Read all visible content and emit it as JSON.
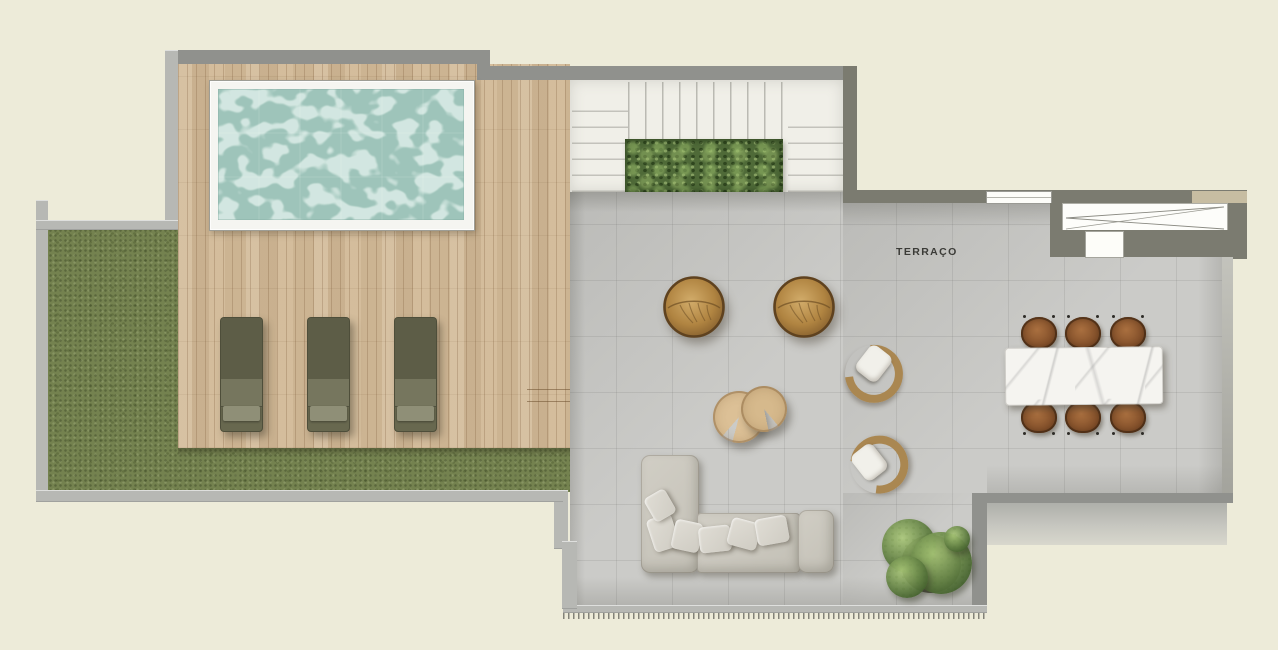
{
  "document_type": "roof terrace floor plan (top view render)",
  "labels": {
    "terrace": "TERRAÇO"
  },
  "colors": {
    "background": "#edebd9",
    "wall_dark": "#7b7b70",
    "wall_medium": "#90918d",
    "wall_light": "#b7b8b4",
    "wood_deck": "#d2ba98",
    "grass": "#74824f",
    "tile": "#cbcbc8",
    "stairs": "#f0efe8",
    "hedge": "#4f6a38",
    "pool_water": "#a5cbc1",
    "pool_frame": "#f5f5f1",
    "pouf": "#bb954f",
    "lounger": "#68684f",
    "side_table": "#dcc096",
    "armchair_frame": "#aa8751",
    "cushion": "#f1f0ea",
    "sofa": "#c9c6bc",
    "marble": "#f5f4f0",
    "dining_chair": "#8d5834",
    "plant_green": "#5f7d41",
    "label_color": "#3b3b37"
  },
  "areas": [
    "lawn",
    "wood deck",
    "swimming pool",
    "staircase with hedge planter",
    "terrace (TERRAÇO)"
  ],
  "furniture": [
    "3 sun loungers on deck",
    "2 round carved gold poufs",
    "2 wooden C-shaped side tables",
    "2 rattan barrel armchairs with white cushions",
    "L-shaped sectional sofa with throw pillows",
    "rectangular marble dining table",
    "6 wicker dining chairs",
    "potted shrub",
    "sliding glass door (top right)",
    "window in top wall"
  ]
}
